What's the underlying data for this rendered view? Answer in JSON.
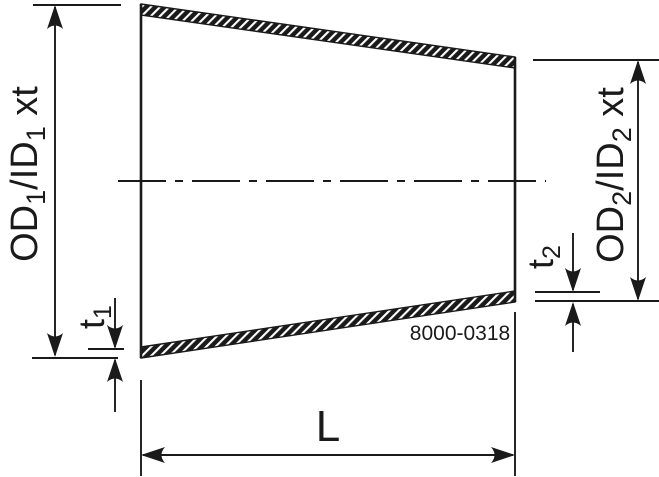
{
  "drawing": {
    "background_color": "#ffffff",
    "line_color": "#1a1a1a",
    "labels": {
      "od1": {
        "prefix": "OD",
        "sub1": "1",
        "mid": "/ID",
        "sub2": "1",
        "suffix": " xt"
      },
      "od2": {
        "prefix": "OD",
        "sub1": "2",
        "mid": "/ID",
        "sub2": "2",
        "suffix": " xt"
      },
      "t1": {
        "prefix": "t",
        "sub": "1"
      },
      "t2": {
        "prefix": "t",
        "sub": "2"
      },
      "length": "L",
      "drawing_number": "8000-0318"
    }
  }
}
